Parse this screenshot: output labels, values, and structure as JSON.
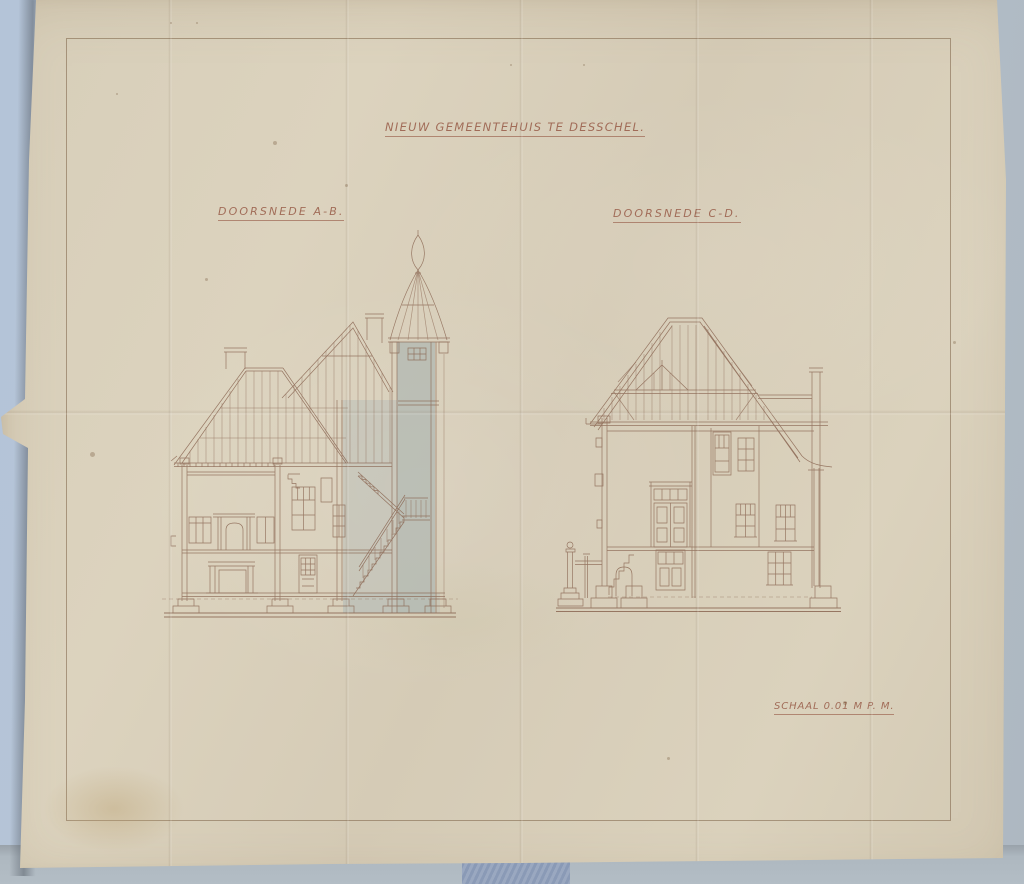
{
  "sheet": {
    "title": "NIEUW GEMEENTEHUIS TE DESSCHEL.",
    "drawings": [
      {
        "name": "cross-section-a-b",
        "label": "DOORSNEDE A-B."
      },
      {
        "name": "cross-section-c-d",
        "label": "DOORSNEDE C-D."
      }
    ],
    "scale_note": "SCHAAL 0.01 M P. M.",
    "colors": {
      "paper": "#d8cfba",
      "backdrop": "#b5c3d4",
      "ink": "#8b6753",
      "lettering": "#9a5f4b",
      "wash_blue_gray": "#b1bab5",
      "border_frame": "#7c6046"
    }
  }
}
